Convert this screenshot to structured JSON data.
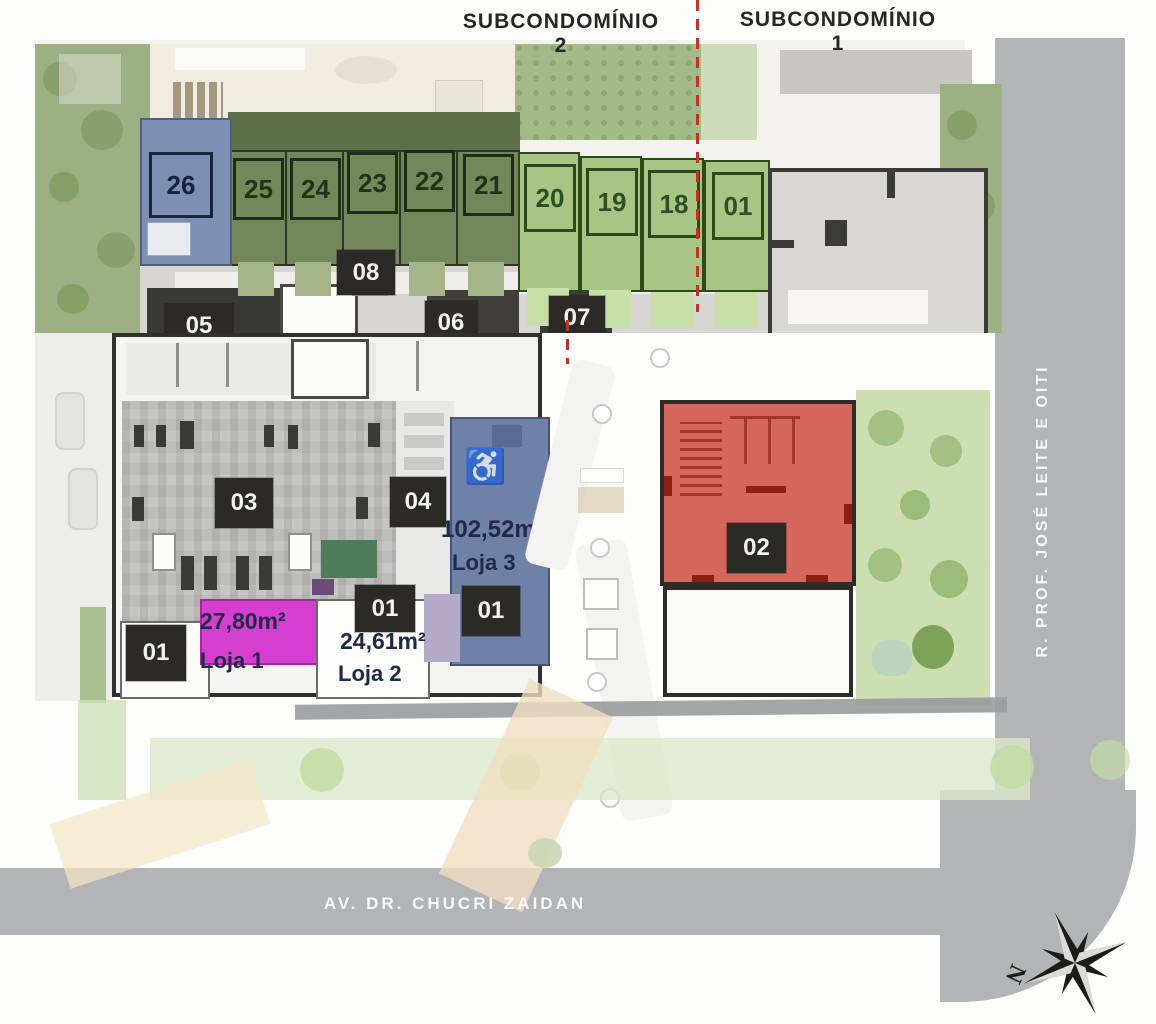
{
  "title_labels": {
    "sub2": "SUBCONDOMÍNIO 2",
    "sub1": "SUBCONDOMÍNIO 1"
  },
  "units": [
    {
      "label": "26"
    },
    {
      "label": "25"
    },
    {
      "label": "24"
    },
    {
      "label": "23"
    },
    {
      "label": "22"
    },
    {
      "label": "21"
    },
    {
      "label": "20"
    },
    {
      "label": "19"
    },
    {
      "label": "18"
    },
    {
      "label": "01"
    }
  ],
  "unit_row_labels": {
    "l08": "08"
  },
  "cut_labels": {
    "l05": "05",
    "l06": "06",
    "l07": "07"
  },
  "building_labels": {
    "l03": "03",
    "l04": "04",
    "l02": "02",
    "l01_left": "01",
    "l01_mid": "01",
    "l01_blue": "01"
  },
  "shops": {
    "loja1": {
      "area": "27,80m²",
      "name": "Loja 1"
    },
    "loja2": {
      "area": "24,61m²",
      "name": "Loja 2"
    },
    "loja3": {
      "area": "102,52m²",
      "name": "Loja 3"
    }
  },
  "streets": {
    "bottom": "AV. DR. CHUCRI ZAIDAN",
    "right": "R. PROF. JOSÉ LEITE E OITI"
  },
  "compass": {
    "north": "N"
  },
  "icons": {
    "wheelchair": "♿"
  },
  "colors": {
    "boundary_red": "#c03428",
    "unit_olive": "#76865b",
    "unit_light_green": "#a9c585",
    "unit_blue": "#7d8fb2",
    "loja3_blue": "#6f81a6",
    "loja1_magenta": "#d53fd0",
    "building02_red": "#d5665c",
    "label_box_dark": "#2b2a27",
    "street_gray": "#b2b4b5"
  }
}
